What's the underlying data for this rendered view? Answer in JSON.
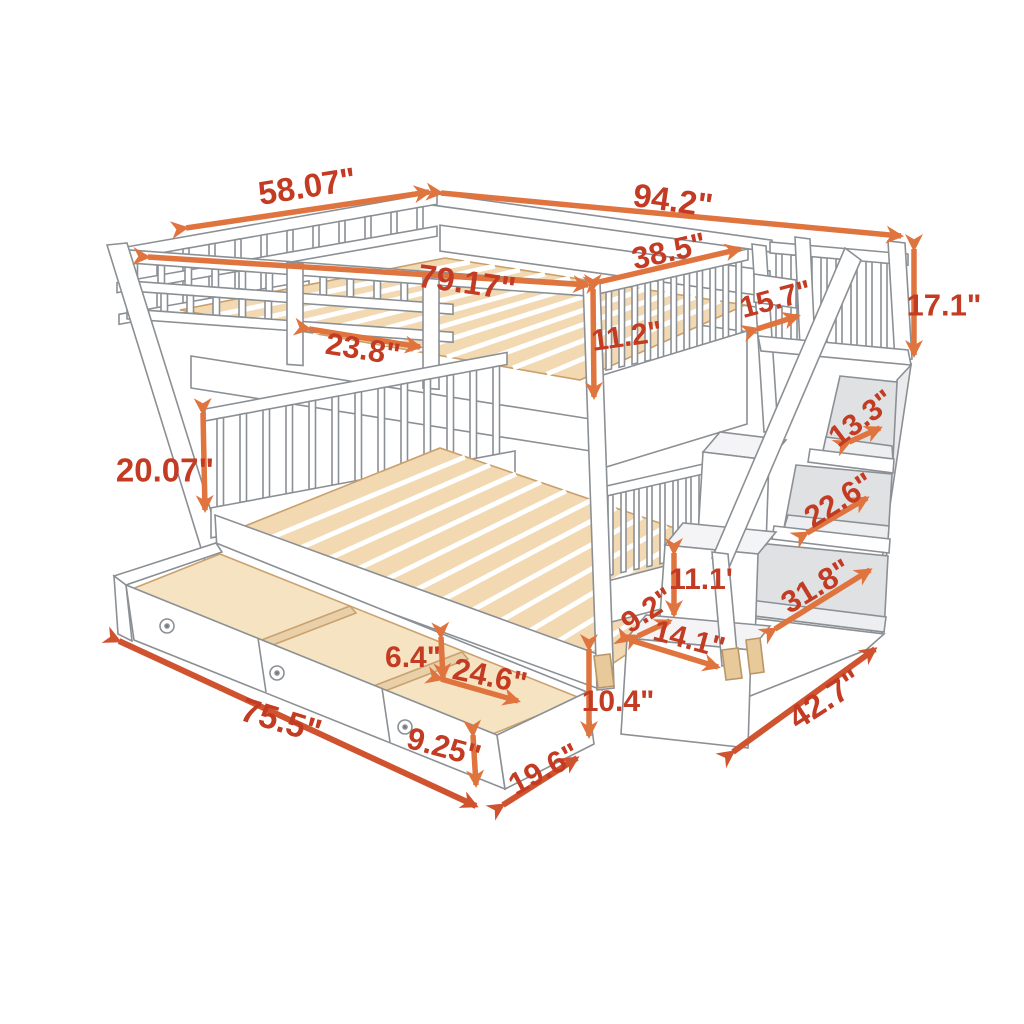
{
  "meta": {
    "title": "Bunk bed with staircase storage and trundle drawers - dimension diagram",
    "unit": "inches",
    "style": "line-art product sketch with orange dimension arrows"
  },
  "colors": {
    "label_text": "#c23b22",
    "arrow_orange": "#e0743e",
    "arrow_red": "#d0532f",
    "wood_fill": "#f2d9b2",
    "drawer_wood": "#f6e3c1",
    "line_art": "#8b9095",
    "cubby_shade": "#dfe1e3"
  },
  "product": {
    "type": "full-over-full bunk bed with storage staircase and 3-compartment trundle drawer"
  },
  "dimensions": [
    {
      "id": "upper-bed-width",
      "label": "58.07\""
    },
    {
      "id": "total-length",
      "label": "94.2\""
    },
    {
      "id": "upper-interior-length",
      "label": "79.17\""
    },
    {
      "id": "foot-rail-length",
      "label": "38.5\""
    },
    {
      "id": "guard-rail-opening",
      "label": "23.8\""
    },
    {
      "id": "upper-guard-height",
      "label": "11.2\""
    },
    {
      "id": "stair-landing-depth",
      "label": "15.7\""
    },
    {
      "id": "top-rail-height",
      "label": "17.1\""
    },
    {
      "id": "shelf-top-width",
      "label": "13.3\""
    },
    {
      "id": "shelf-middle-width",
      "label": "22.6\""
    },
    {
      "id": "shelf-bottom-width",
      "label": "31.8\""
    },
    {
      "id": "step-rise",
      "label": "11.1'"
    },
    {
      "id": "step-depth",
      "label": "9.2\""
    },
    {
      "id": "step-width",
      "label": "14.1\""
    },
    {
      "id": "under-bed-clearance",
      "label": "10.4\""
    },
    {
      "id": "staircase-depth",
      "label": "42.7\""
    },
    {
      "id": "lower-guard-height",
      "label": "20.07\""
    },
    {
      "id": "drawer-inner-height",
      "label": "6.4\""
    },
    {
      "id": "drawer-compartment-length",
      "label": "24.6\""
    },
    {
      "id": "drawer-length",
      "label": "75.5\""
    },
    {
      "id": "drawer-front-height",
      "label": "9.25\""
    },
    {
      "id": "drawer-depth",
      "label": "19.6\""
    }
  ]
}
